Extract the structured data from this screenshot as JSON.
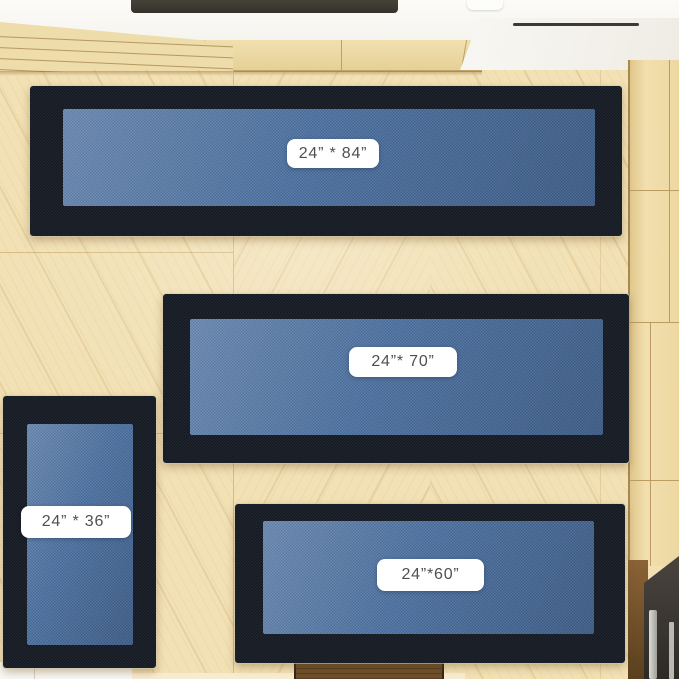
{
  "scene": {
    "description": "Top-down view of a kitchen with light chevron wood flooring; four blue runner rugs with dark navy borders are laid out, each with a white size label pill.",
    "rugs": [
      {
        "id": "rug-24x84",
        "label": "24” * 84”"
      },
      {
        "id": "rug-24x70",
        "label": "24”* 70”"
      },
      {
        "id": "rug-24x36",
        "label": "24” * 36”"
      },
      {
        "id": "rug-24x60",
        "label": "24”*60”"
      }
    ],
    "colors": {
      "rug_border": "#151b25",
      "rug_pile": "#4d72a2",
      "floor_wood": "#f2e1b5",
      "cabinet_wood": "#ecd7a0",
      "counter_white": "#fbfaf7",
      "stove_bar": "#3a372f",
      "oven_dark": "#3a3531",
      "oven_handle_silver": "#c9c9c4",
      "floor_vent_brown": "#6d4f2c",
      "label_background": "#ffffff",
      "label_text": "#505050"
    }
  }
}
